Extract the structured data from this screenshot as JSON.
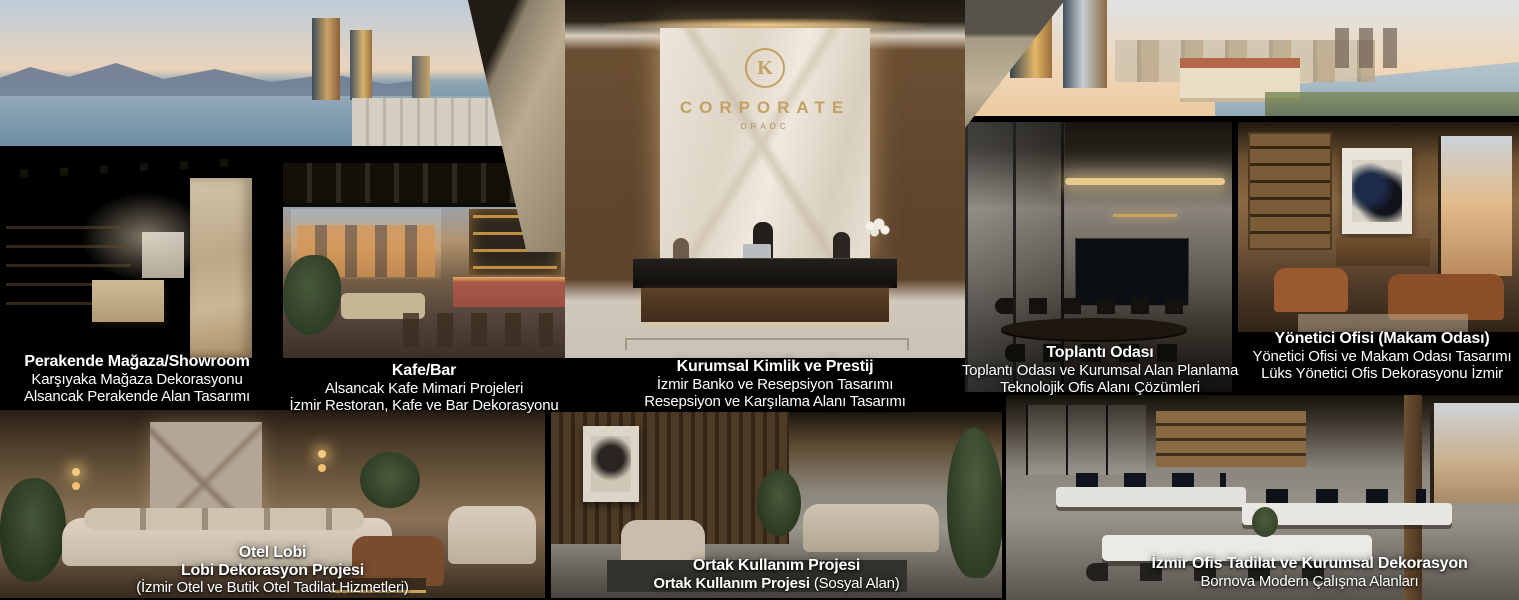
{
  "page": {
    "width": 1519,
    "height": 600,
    "background": "#000000"
  },
  "colors": {
    "caption_text": "#ffffff",
    "logo_gold": "#c2a264",
    "gap_black": "#000000"
  },
  "logo": {
    "monogram": "K",
    "name": "CORPORATE",
    "tagline": "ORAOC"
  },
  "captions": {
    "showroom": {
      "title": "Perakende Mağaza/Showroom",
      "line2": "Karşıyaka Mağaza Dekorasyonu",
      "line3": "Alsancak Perakende Alan Tasarımı"
    },
    "cafe": {
      "title": "Kafe/Bar",
      "line2": "Alsancak Kafe Mimari Projeleri",
      "line3": "İzmir Restoran, Kafe ve Bar Dekorasyonu"
    },
    "reception": {
      "title": "Kurumsal Kimlik ve Prestij",
      "line2": "İzmir Banko ve Resepsiyon Tasarımı",
      "line3": "Resepsiyon ve Karşılama Alanı Tasarımı"
    },
    "meeting": {
      "title": "Toplantı Odası",
      "line2": "Toplantı Odası ve Kurumsal Alan Planlama",
      "line3": "Teknolojik Ofis Alanı Çözümleri"
    },
    "executive": {
      "title": "Yönetici Ofisi (Makam Odası)",
      "line2": "Yönetici Ofisi ve Makam Odası Tasarımı",
      "line3": "Lüks Yönetici Ofis Dekorasyonu İzmir"
    },
    "hotel": {
      "title": "Otel Lobi",
      "line2": "Lobi Dekorasyon Projesi",
      "line3": "(İzmir Otel ve Butik Otel Tadilat Hizmetleri)"
    },
    "common": {
      "title": "Ortak Kullanım Projesi",
      "line2_bold": "Ortak Kullanım Projesi",
      "line2_rest": " (Sosyal Alan)"
    },
    "office": {
      "title": "İzmir Ofis Tadilat ve Kurumsal Dekorasyon",
      "line2": "Bornova Modern Çalışma Alanları"
    }
  }
}
